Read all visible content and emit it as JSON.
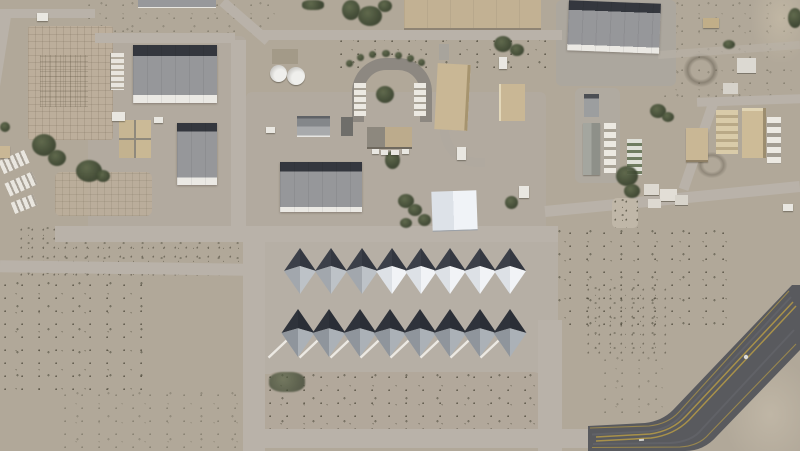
{
  "meta": {
    "title": "Aerial satellite view of a desert airbase: warehouse cluster, two rows of eight A-frame shelter tents on a concrete apron, and a diagonal taxiway with yellow markings",
    "image_type": "satellite-aerial-photo",
    "features": {
      "large_gray_roof_warehouses": 4,
      "tent_rows": 2,
      "tents_per_row": 8,
      "white_fabric_shelter": 1,
      "storage_tanks": 2,
      "gridded_concrete_pads": 2,
      "taxiway": "diagonal, lower right, dark asphalt with double yellow centerline",
      "terrain": "mottled desert with sparse dark vegetation"
    }
  },
  "palette": {
    "desert": "#b1a899",
    "apron": "#b6afa5",
    "road": "#b9b2a9",
    "roof_gray": "#96979a",
    "roof_dark": "#34373e",
    "roof_eave": "#ebe9e4",
    "tan_roof": "#c9b795",
    "vegetation": "#3c4630",
    "taxiway": "#595a5e",
    "taxiway_line": "#a8914a"
  },
  "tents": {
    "stripe_color": "#ece9e3",
    "variants": {
      "gray1": {
        "nw": "#3c4049",
        "ne": "#333740",
        "sw": "#a2a7ad",
        "se": "#bdc2c7"
      },
      "white": {
        "nw": "#3c4049",
        "ne": "#333740",
        "sw": "#dde1e6",
        "se": "#f1f3f6"
      },
      "gray2": {
        "nw": "#2f333b",
        "ne": "#2a2e36",
        "sw": "#8f959c",
        "se": "#abb1b7"
      }
    },
    "rows": [
      {
        "name": "north-row",
        "y": 248,
        "h": 46,
        "w": 32,
        "peak": 0.39,
        "ground_stripes": false,
        "items": [
          {
            "cx": 300,
            "variant": "gray1"
          },
          {
            "cx": 331,
            "variant": "gray1"
          },
          {
            "cx": 362,
            "variant": "gray1"
          },
          {
            "cx": 392,
            "variant": "white"
          },
          {
            "cx": 421,
            "variant": "white"
          },
          {
            "cx": 450,
            "variant": "white"
          },
          {
            "cx": 480,
            "variant": "white"
          },
          {
            "cx": 510,
            "variant": "white"
          }
        ]
      },
      {
        "name": "south-row",
        "y": 309,
        "h": 48,
        "w": 33,
        "peak": 0.4,
        "ground_stripes": true,
        "items": [
          {
            "cx": 298,
            "variant": "gray2"
          },
          {
            "cx": 329,
            "variant": "gray2"
          },
          {
            "cx": 360,
            "variant": "gray2"
          },
          {
            "cx": 390,
            "variant": "gray2"
          },
          {
            "cx": 420,
            "variant": "gray2"
          },
          {
            "cx": 450,
            "variant": "gray2"
          },
          {
            "cx": 480,
            "variant": "gray2"
          },
          {
            "cx": 510,
            "variant": "gray2"
          }
        ]
      }
    ]
  }
}
